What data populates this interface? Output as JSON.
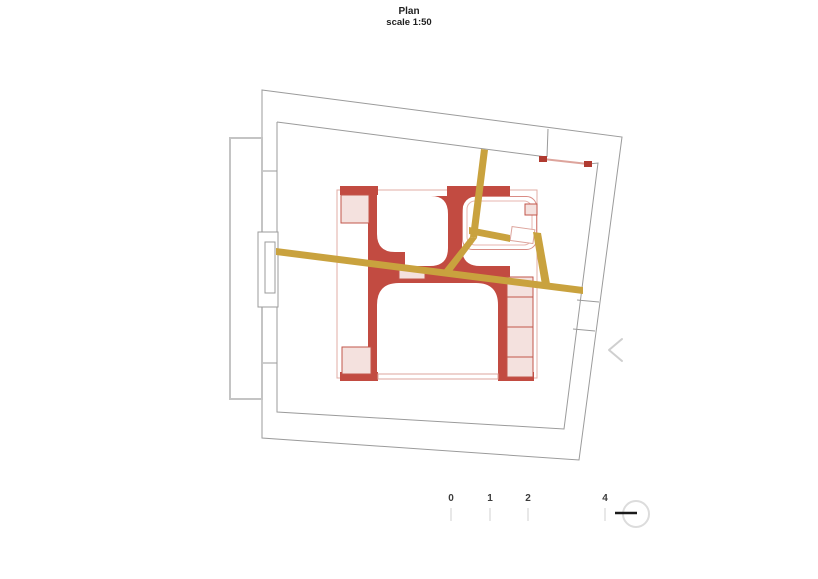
{
  "page": {
    "title": "Plan",
    "subtitle": "scale 1:50"
  },
  "plan": {
    "kind": "architectural-floor-plan",
    "colors": {
      "shell_line": "#9b9b9b",
      "balcony_line": "#c4c4c4",
      "red_wall": "#c24b41",
      "red_accent": "#b03a30",
      "pink_fill": "#f4e1de",
      "pink_line": "#dda49c",
      "gold_beam": "#c9a23e",
      "chevron": "#cfcfcf",
      "symbol_ring": "#dcdcdc"
    },
    "icons": [
      {
        "name": "chevron-left-icon"
      },
      {
        "name": "north-orientation-icon"
      }
    ]
  },
  "scale_bar": {
    "labels": [
      "0",
      "1",
      "2",
      "4"
    ]
  }
}
